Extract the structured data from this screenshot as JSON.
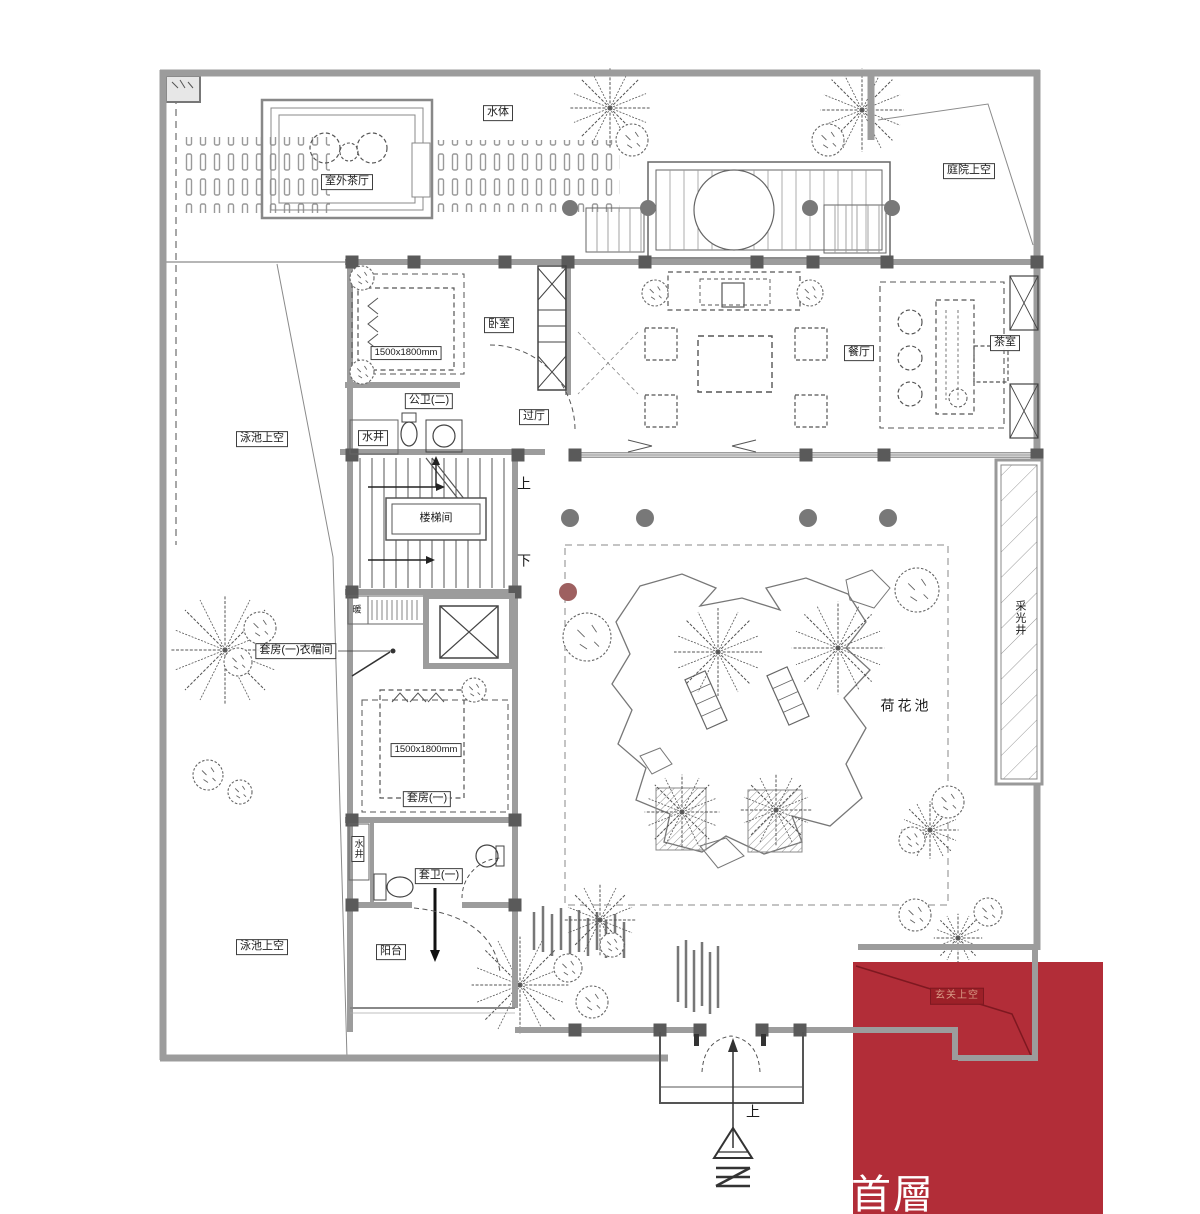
{
  "colors": {
    "accent_red": "#b22d38",
    "accent_red_dark": "#7e1820",
    "entry_box_fill": "#9c2028",
    "label_red_text": "#d99a85",
    "wall_gray": "#9c9c9c",
    "line_dark": "#555555"
  },
  "labels": {
    "water_body": "水体",
    "outdoor_tea_hall": "室外茶厅",
    "courtyard_above": "庭院上空",
    "bedroom": "卧室",
    "bed_size_top": "1500x1800mm",
    "public_bath_2": "公卫(二)",
    "passage_hall": "过厅",
    "dining_room": "餐厅",
    "tea_room": "茶室",
    "water_well_top": "水井",
    "pool_above_left": "泳池上空",
    "stair_hall": "楼梯间",
    "up_stairs": "上",
    "down_stairs": "下",
    "heating": "暖",
    "suite1_cloakroom": "套房(一)衣帽间",
    "bed_size_suite": "1500x1800mm",
    "suite1": "套房(一)",
    "water_well_bottom": "水井",
    "suite1_bath": "套卫(一)",
    "balcony": "阳台",
    "pool_above_bottom": "泳池上空",
    "lotus_pond": "荷花池",
    "light_well": "采光井",
    "entry_above": "玄关上空",
    "up_entrance": "上",
    "floor_tag": "首層"
  }
}
